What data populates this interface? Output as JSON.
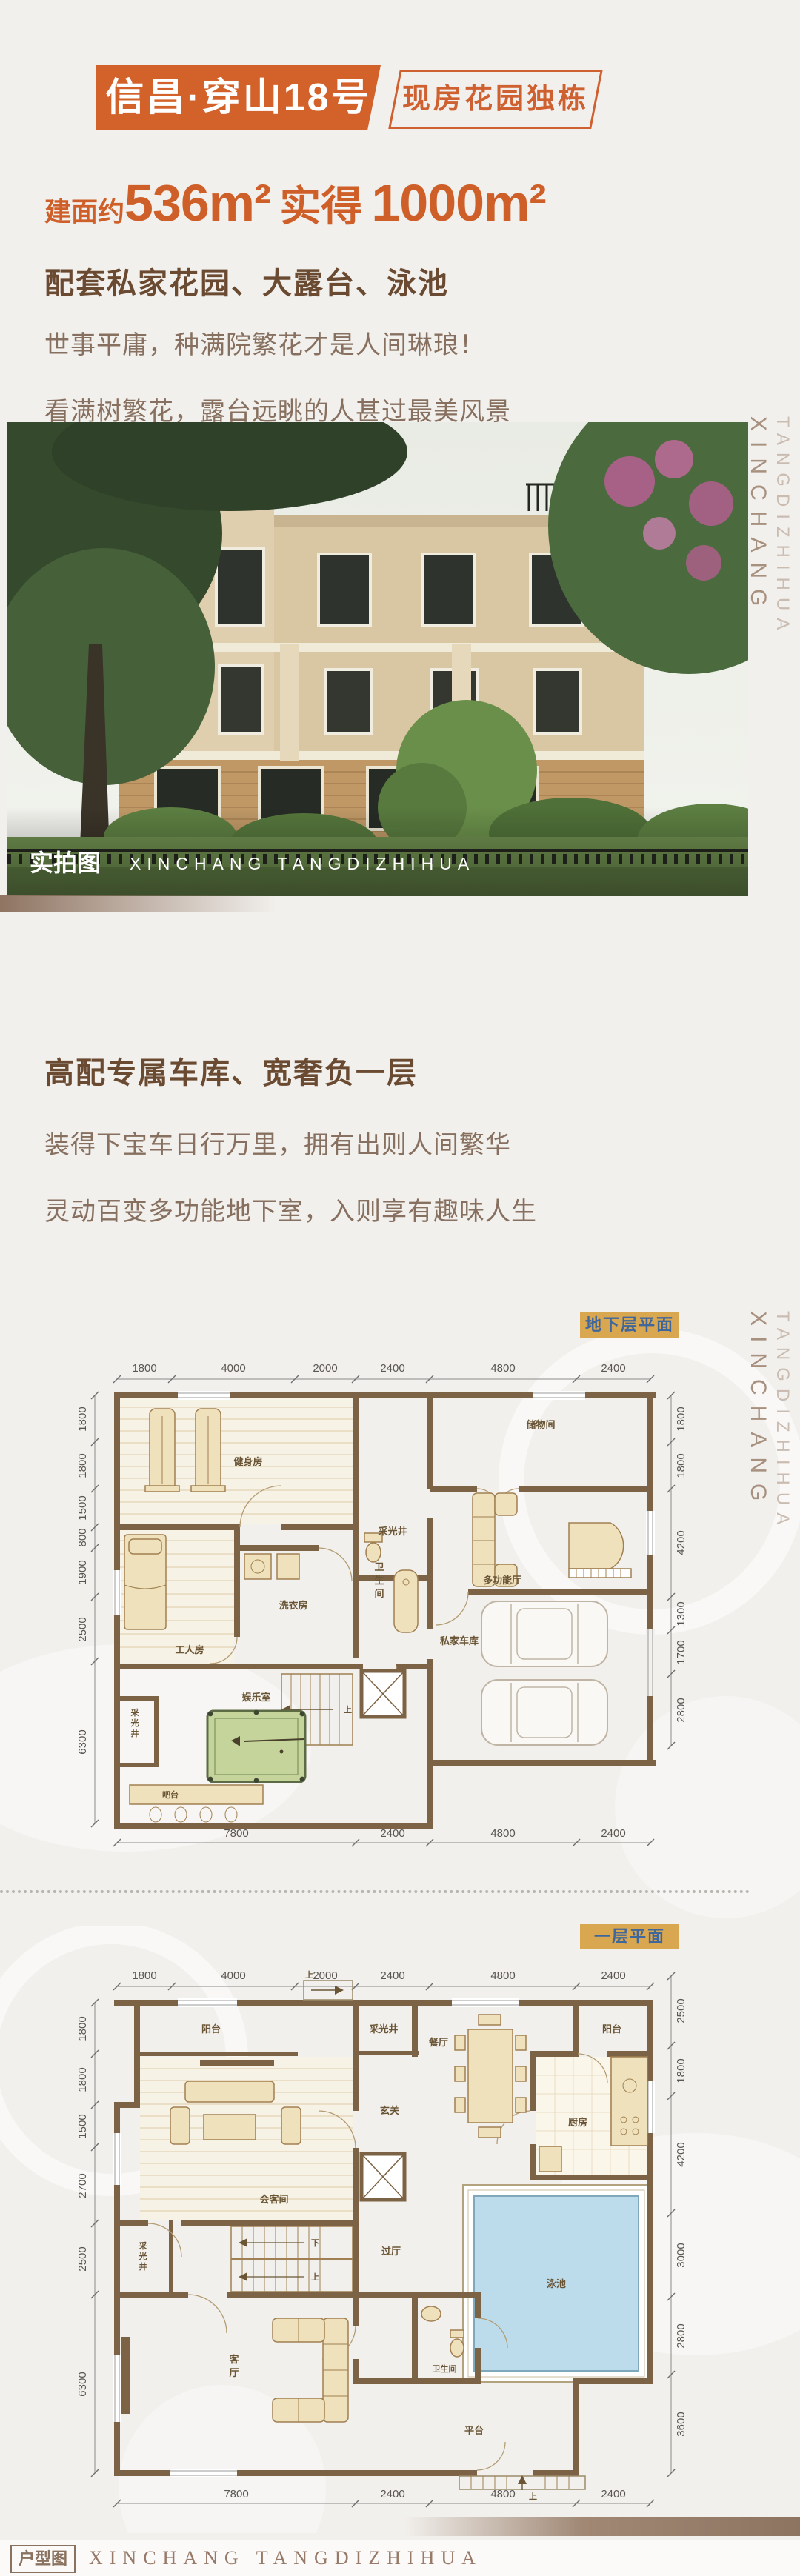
{
  "header": {
    "title": "信昌·穿山18号",
    "badge": "现房花园独栋"
  },
  "hero": {
    "area_prefix": "建面约",
    "area_main": "536m²",
    "area_mid": "实得",
    "area_second": "1000m²",
    "features": "配套私家花园、大露台、泳池",
    "line1": "世事平庸，种满院繁花才是人间琳琅！",
    "line2": "看满树繁花，露台远眺的人甚过最美风景"
  },
  "photo": {
    "tag": "实拍图",
    "brand": "XINCHANG TANGDIZHIHUA"
  },
  "sidebar": {
    "top": "TANGDIZHIHUA",
    "bottom": "XINCHANG"
  },
  "garage_section": {
    "title": "高配专属车库、宽奢负一层",
    "line1": "装得下宝车日行万里，拥有出则人间繁华",
    "line2": "灵动百变多功能地下室，入则享有趣味人生"
  },
  "basement": {
    "badge": "地下层平面",
    "dims_top": [
      "1800",
      "4000",
      "2000",
      "2400",
      "4800",
      "2400"
    ],
    "dims_left": [
      "1800",
      "1800",
      "1500",
      "800",
      "1900",
      "2500",
      "6300"
    ],
    "dims_right": [
      "1800",
      "1800",
      "4200",
      "1300",
      "1700",
      "2800"
    ],
    "dims_bottom": [
      "7800",
      "2400",
      "4800",
      "2400"
    ],
    "rooms": {
      "gym": "健身房",
      "storage": "储物间",
      "lightwell_top": "采光井",
      "lightwell_left": "采光井",
      "worker": "工人房",
      "laundry": "洗衣房",
      "bath": "卫生间",
      "multi": "多功能厅",
      "play": "娱乐室",
      "bar": "吧台",
      "garage": "私家车库",
      "stair_up": "上"
    }
  },
  "floor1": {
    "badge": "一层平面",
    "dims_top": [
      "1800",
      "4000",
      "2000",
      "2400",
      "4800",
      "2400"
    ],
    "dims_left": [
      "1800",
      "1800",
      "1500",
      "2700",
      "2500",
      "6300"
    ],
    "dims_right": [
      "2500",
      "1800",
      "4200",
      "3000",
      "2800",
      "3600"
    ],
    "dims_bottom": [
      "7800",
      "2400",
      "4800",
      "2400"
    ],
    "rooms": {
      "balcony_left": "阳台",
      "balcony_right": "阳台",
      "lightwell_top": "采光井",
      "lightwell_left": "采光井",
      "reception": "会客间",
      "foyer": "玄关",
      "dining": "餐厅",
      "kitchen": "厨房",
      "hall": "过厅",
      "living": "客厅",
      "bath": "卫生间",
      "pool": "泳池",
      "terrace": "平台",
      "stair_up": "上",
      "stair_down": "下",
      "entry_up": "上"
    }
  },
  "footer": {
    "label": "户型图",
    "brand": "XINCHANG TANGDIZHIHUA"
  }
}
